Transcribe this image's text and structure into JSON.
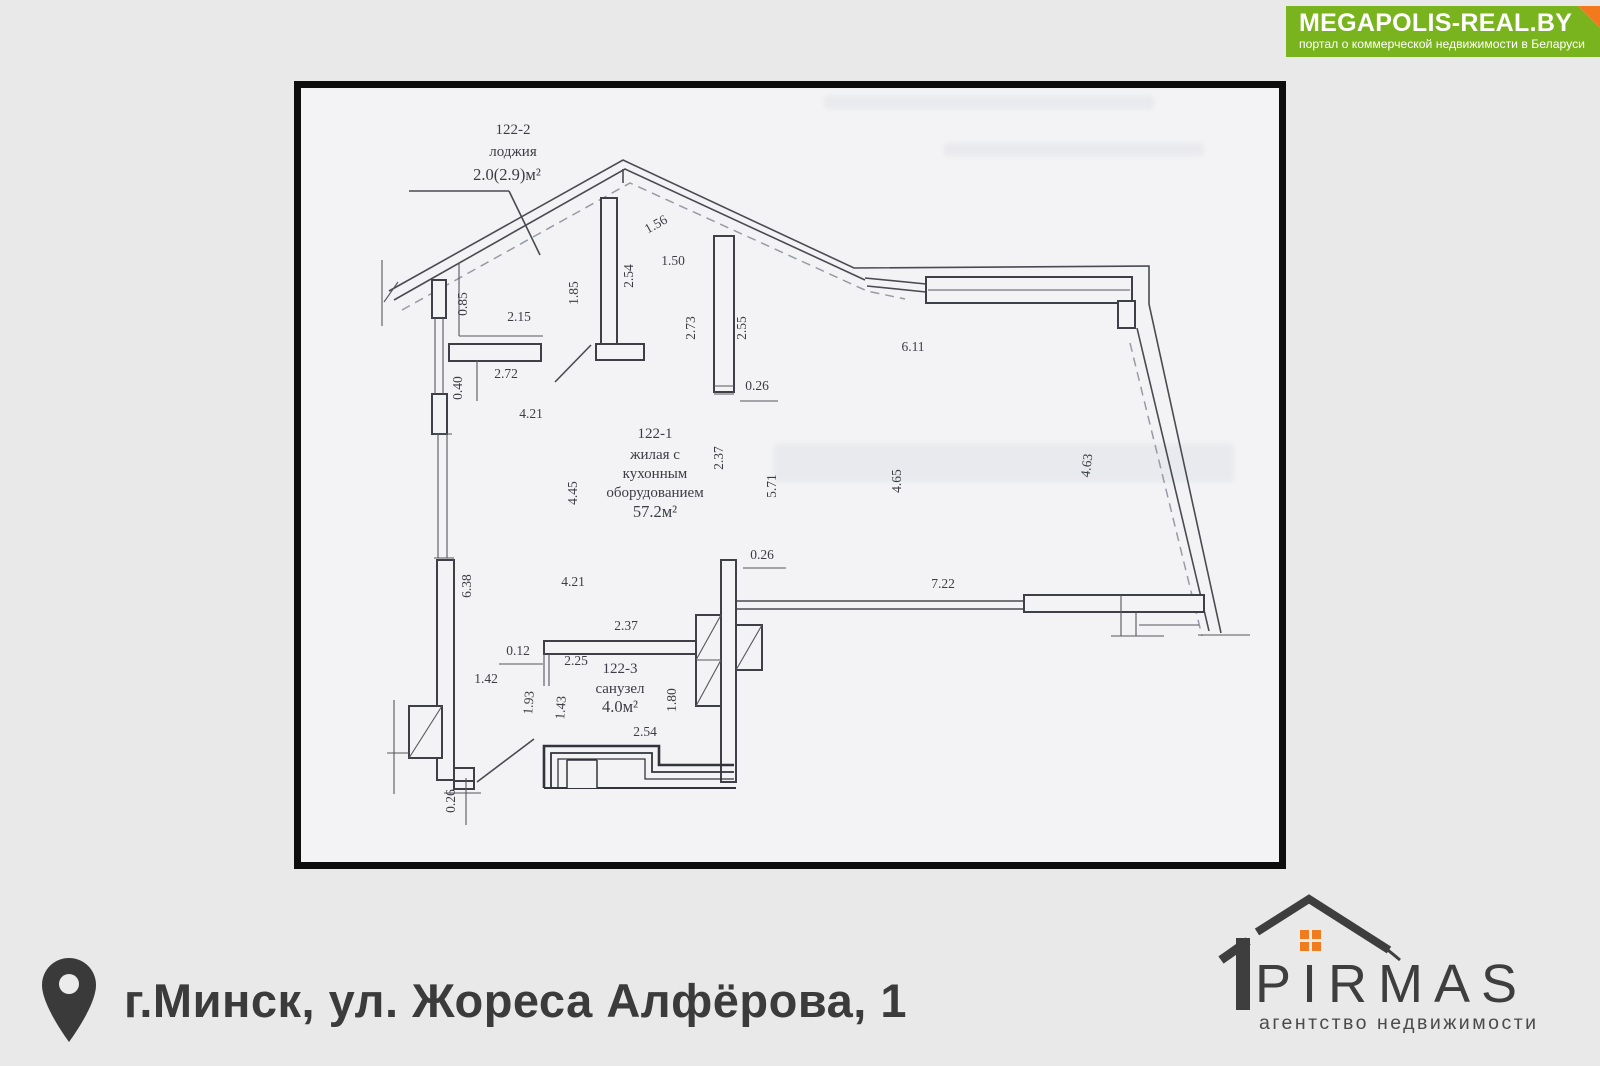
{
  "watermark_logo": {
    "title": "MEGAPOLIS-REAL.BY",
    "subtitle": "портал о коммерческой недвижимости в Беларуси",
    "bg_color": "#79b41e",
    "fold_color": "#f2791d"
  },
  "address": {
    "text": "г.Минск, ул. Жореса Алфёрова, 1"
  },
  "agency": {
    "name": "PIRMAS",
    "tagline": "агентство недвижимости",
    "accent_color": "#ef7c1e"
  },
  "floor_plan": {
    "paper_color": "#f3f3f5",
    "line_color": "#4a4a52",
    "rooms": [
      {
        "id": "122-2",
        "name": "лоджия",
        "area": "2.0(2.9)м²",
        "label_lines": [
          "122-2",
          "лоджия",
          "2.0(2.9)м²"
        ]
      },
      {
        "id": "122-1",
        "name": "жилая с кухонным оборудованием",
        "area": "57.2м²",
        "label_lines": [
          "122-1",
          "жилая с",
          "кухонным",
          "оборудованием",
          "57.2м²"
        ]
      },
      {
        "id": "122-3",
        "name": "санузел",
        "area": "4.0м²",
        "label_lines": [
          "122-3",
          "санузел",
          "4.0м²"
        ]
      }
    ],
    "dim_labels": [
      {
        "t": "0.85",
        "x": 166,
        "y": 216,
        "r": -90
      },
      {
        "t": "2.15",
        "x": 218,
        "y": 233
      },
      {
        "t": "0.40",
        "x": 161,
        "y": 300,
        "r": -90
      },
      {
        "t": "2.72",
        "x": 205,
        "y": 290
      },
      {
        "t": "4.21",
        "x": 230,
        "y": 330
      },
      {
        "t": "1.85",
        "x": 277,
        "y": 205,
        "r": -90
      },
      {
        "t": "2.54",
        "x": 332,
        "y": 188,
        "r": -90
      },
      {
        "t": "1.56",
        "x": 357,
        "y": 140,
        "r": -29
      },
      {
        "t": "1.50",
        "x": 372,
        "y": 177
      },
      {
        "t": "2.73",
        "x": 394,
        "y": 240,
        "r": -90
      },
      {
        "t": "2.55",
        "x": 445,
        "y": 240,
        "r": -90
      },
      {
        "t": "0.26",
        "x": 456,
        "y": 302
      },
      {
        "t": "6.11",
        "x": 612,
        "y": 263
      },
      {
        "t": "4.45",
        "x": 276,
        "y": 405,
        "r": -90
      },
      {
        "t": "2.37",
        "x": 422,
        "y": 370,
        "r": -90
      },
      {
        "t": "5.71",
        "x": 475,
        "y": 398,
        "r": -90
      },
      {
        "t": "4.65",
        "x": 600,
        "y": 393,
        "r": -90
      },
      {
        "t": "4.63",
        "x": 790,
        "y": 378,
        "r": -83
      },
      {
        "t": "0.26",
        "x": 461,
        "y": 471
      },
      {
        "t": "4.21",
        "x": 272,
        "y": 498
      },
      {
        "t": "7.22",
        "x": 642,
        "y": 500
      },
      {
        "t": "2.37",
        "x": 325,
        "y": 542
      },
      {
        "t": "0.12",
        "x": 217,
        "y": 567
      },
      {
        "t": "2.25",
        "x": 275,
        "y": 577
      },
      {
        "t": "1.42",
        "x": 185,
        "y": 595
      },
      {
        "t": "6.38",
        "x": 170,
        "y": 498,
        "r": -90
      },
      {
        "t": "1.93",
        "x": 232,
        "y": 615,
        "r": -86
      },
      {
        "t": "1.43",
        "x": 264,
        "y": 620,
        "r": -86
      },
      {
        "t": "1.80",
        "x": 375,
        "y": 612,
        "r": -90
      },
      {
        "t": "2.54",
        "x": 344,
        "y": 648
      },
      {
        "t": "0.26",
        "x": 154,
        "y": 713,
        "r": -90
      }
    ]
  }
}
